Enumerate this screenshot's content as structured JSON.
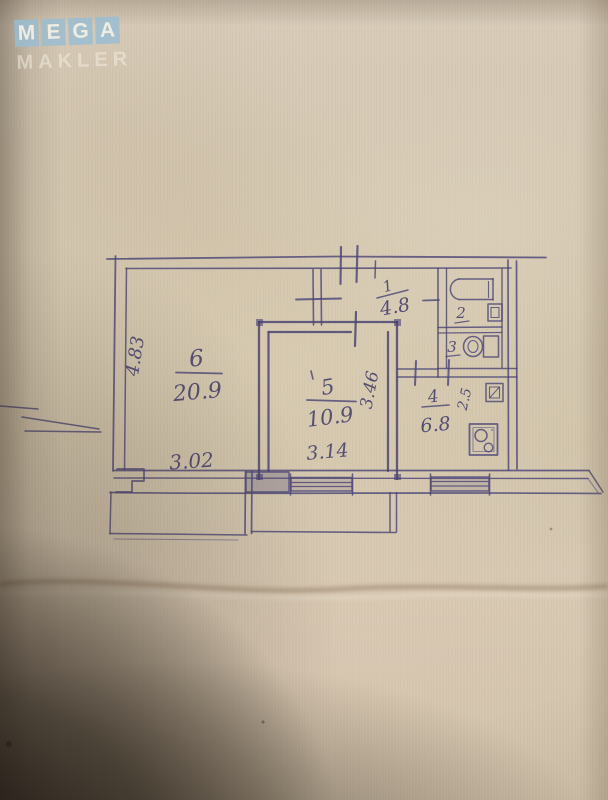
{
  "watermark": {
    "letters": [
      "M",
      "E",
      "G",
      "A"
    ],
    "subtitle": "MAKLER",
    "tile_color": "#98bcd2",
    "text_color": "#f3eee3"
  },
  "plan": {
    "ink_color": "#4d4777",
    "paper_color": "#d4c7b0",
    "shadow_color": "#201910",
    "rooms": {
      "r1": {
        "number": "1",
        "area": "4.8"
      },
      "r2": {
        "number": "2"
      },
      "r3": {
        "number": "3"
      },
      "r4": {
        "number": "4",
        "area": "6.8"
      },
      "r5": {
        "number": "5",
        "area": "10.9"
      },
      "r6": {
        "number": "6",
        "area": "20.9"
      }
    },
    "dimensions": {
      "d483": "4.83",
      "d302": "3.02",
      "d314": "3.14",
      "d346": "3.46",
      "d25": "2.5"
    },
    "fixture_icons": [
      "bathtub-icon",
      "toilet-icon",
      "sink-icon",
      "stove-icon",
      "vent-icon"
    ]
  }
}
